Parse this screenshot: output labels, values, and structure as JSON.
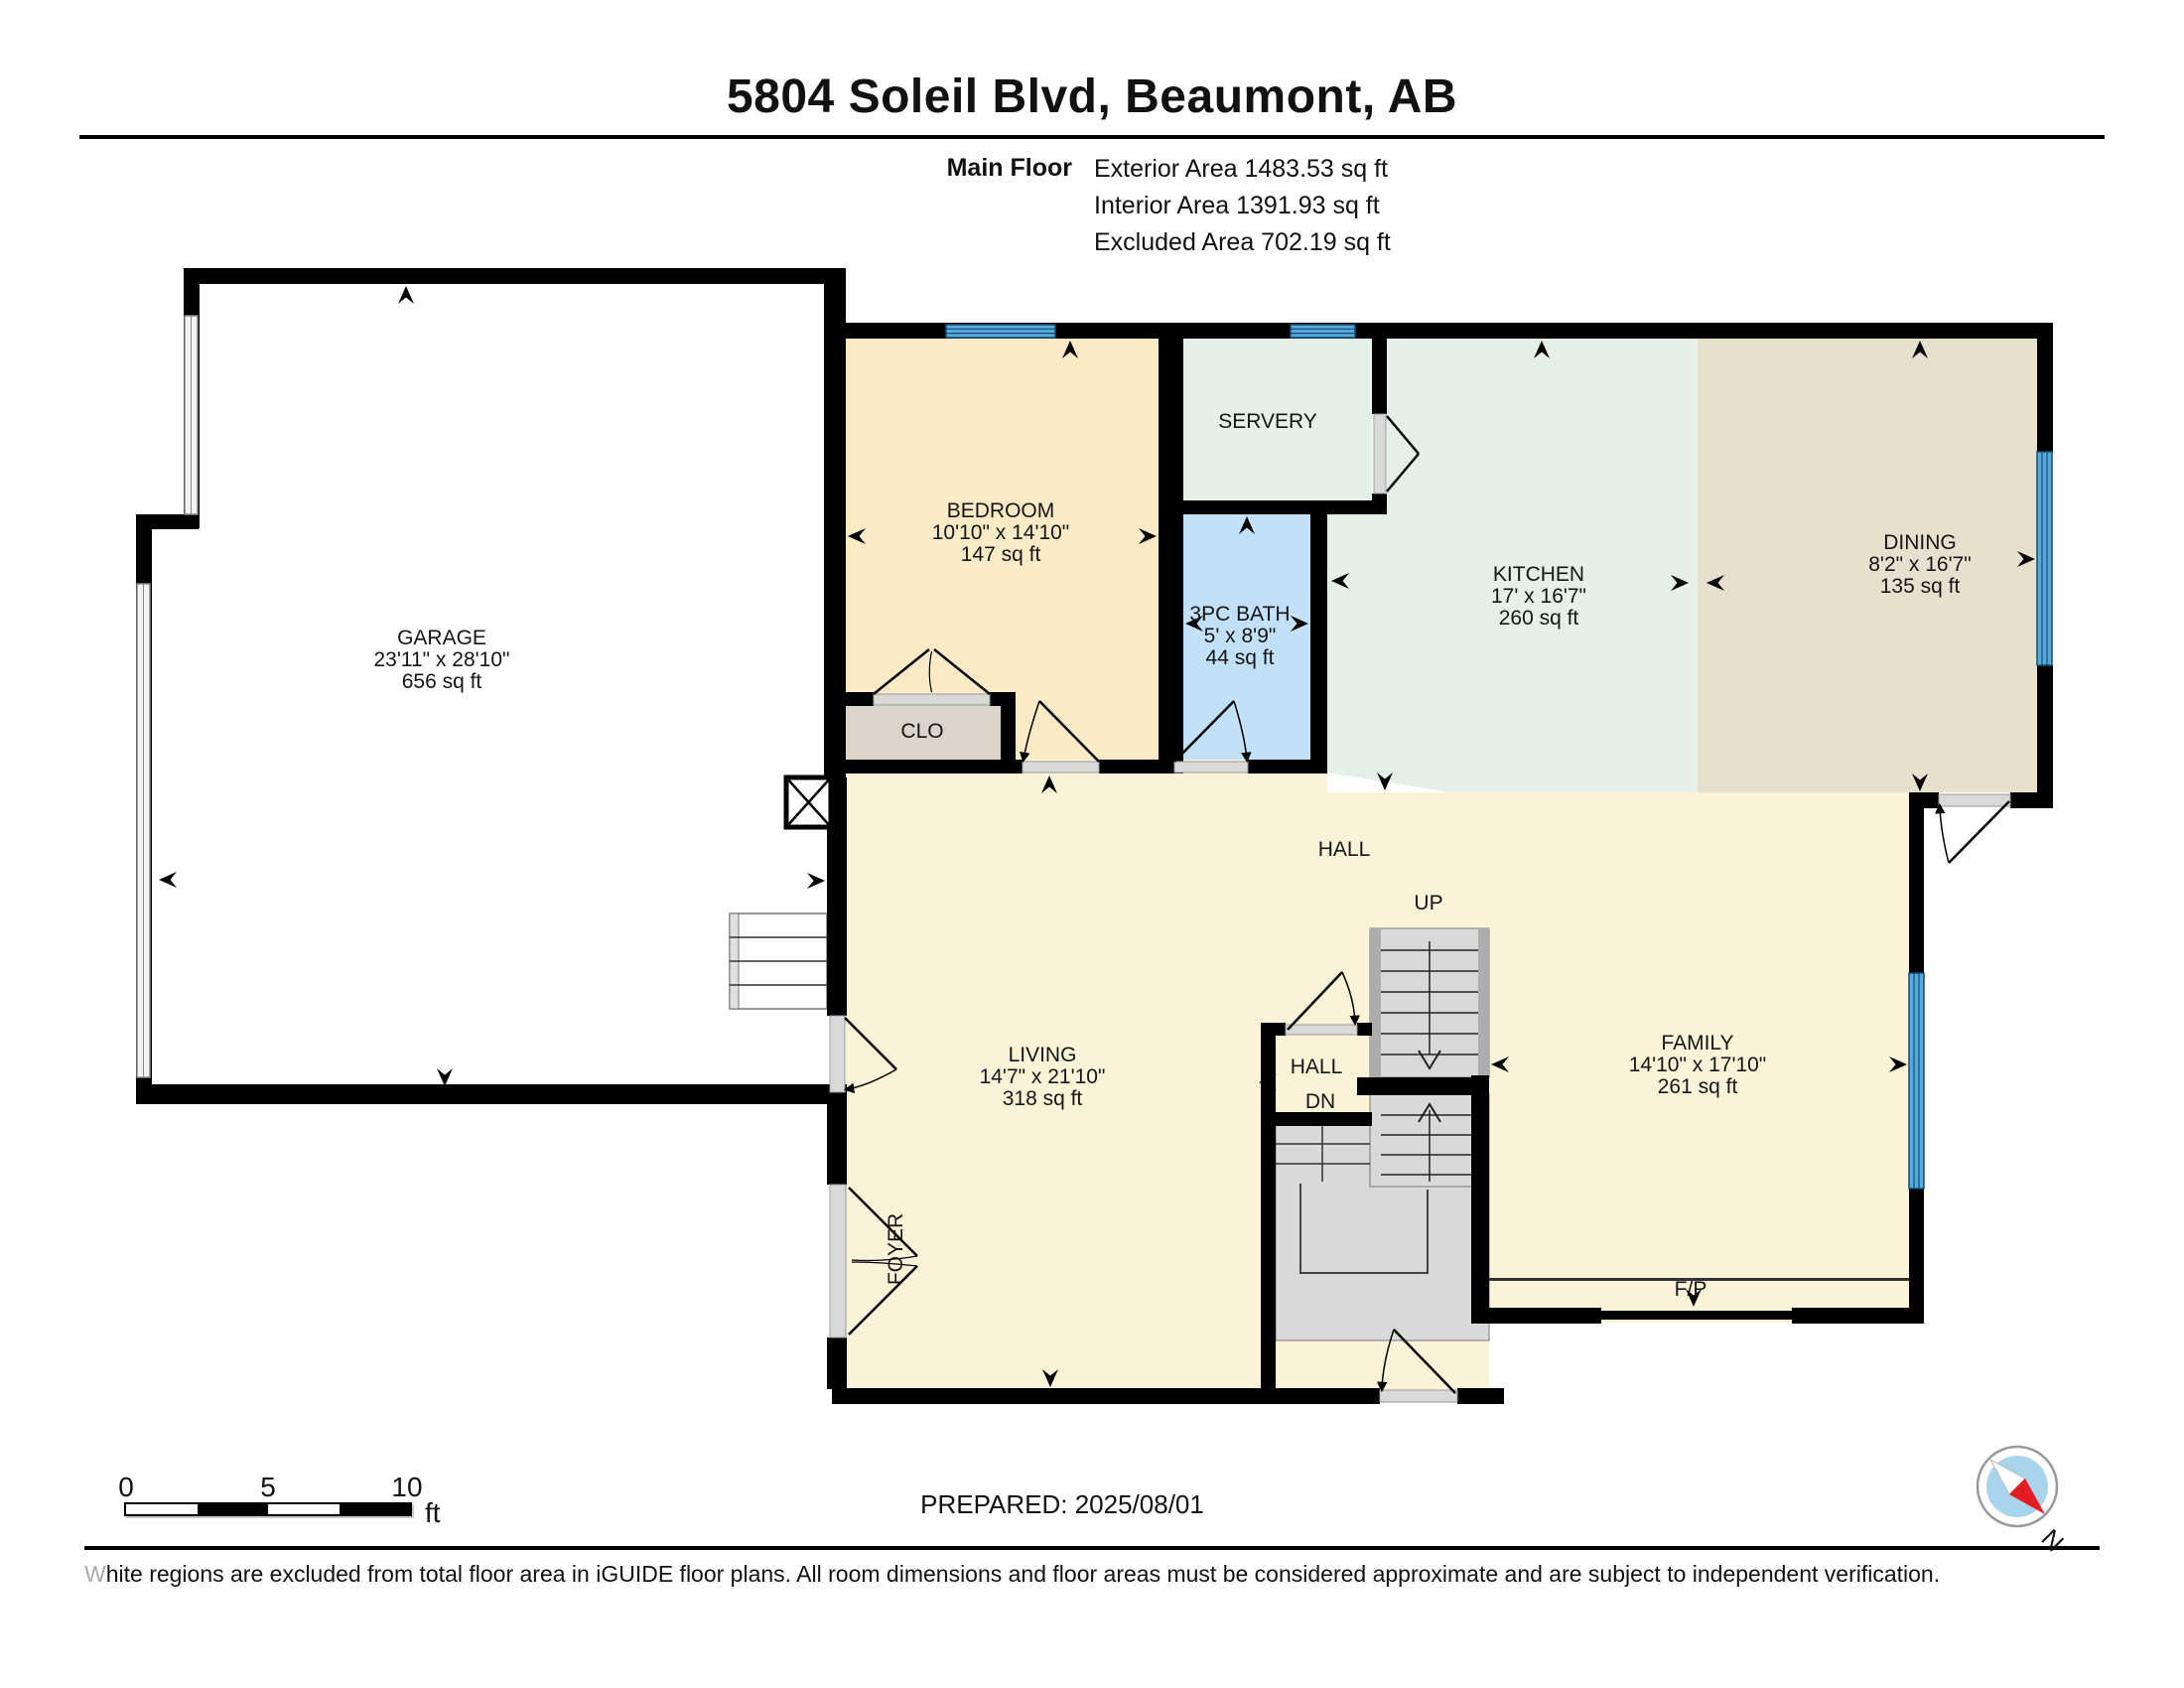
{
  "header": {
    "title": "5804 Soleil Blvd, Beaumont, AB",
    "floor_label": "Main Floor",
    "exterior_area": "Exterior Area 1483.53 sq ft",
    "interior_area": "Interior Area 1391.93 sq ft",
    "excluded_area": "Excluded Area 702.19 sq ft"
  },
  "rooms": {
    "garage": {
      "name": "GARAGE",
      "dims": "23'11\" x 28'10\"",
      "area": "656 sq ft"
    },
    "bedroom": {
      "name": "BEDROOM",
      "dims": "10'10\" x 14'10\"",
      "area": "147 sq ft"
    },
    "servery": {
      "name": "SERVERY"
    },
    "bath": {
      "name": "3PC BATH",
      "dims": "5' x 8'9\"",
      "area": "44 sq ft"
    },
    "kitchen": {
      "name": "KITCHEN",
      "dims": "17' x 16'7\"",
      "area": "260 sq ft"
    },
    "dining": {
      "name": "DINING",
      "dims": "8'2\" x 16'7\"",
      "area": "135 sq ft"
    },
    "living": {
      "name": "LIVING",
      "dims": "14'7\" x 21'10\"",
      "area": "318 sq ft"
    },
    "family": {
      "name": "FAMILY",
      "dims": "14'10\" x 17'10\"",
      "area": "261 sq ft"
    },
    "closet": {
      "name": "CLO"
    },
    "hall": {
      "name": "HALL"
    },
    "hall_small": {
      "name": "HALL",
      "direction": "DN"
    },
    "stairs_up": {
      "label": "UP"
    },
    "foyer": {
      "name": "FOYER"
    },
    "fireplace": {
      "label": "F/P"
    }
  },
  "footer": {
    "scale_ticks": {
      "zero": "0",
      "five": "5",
      "ten": "10"
    },
    "scale_unit": "ft",
    "prepared": "PREPARED: 2025/08/01",
    "compass_north": "N",
    "disclaimer": "White regions are excluded from total floor area in iGUIDE floor plans. All room dimensions and floor areas must be considered approximate and are subject to independent verification."
  },
  "colors": {
    "wall": "#000000",
    "bedroom_fill": "#FAEBC6",
    "living_fill": "#FBF3D8",
    "kitchen_fill": "#E5F0E9",
    "bath_fill": "#C2E1F8",
    "dining_fill": "#E7E0CF",
    "closet_fill": "#DBD4C8",
    "window_blue": "#58A8D8",
    "stairs_gray": "#D9D9D9",
    "compass_needle_red": "#E31B23"
  }
}
